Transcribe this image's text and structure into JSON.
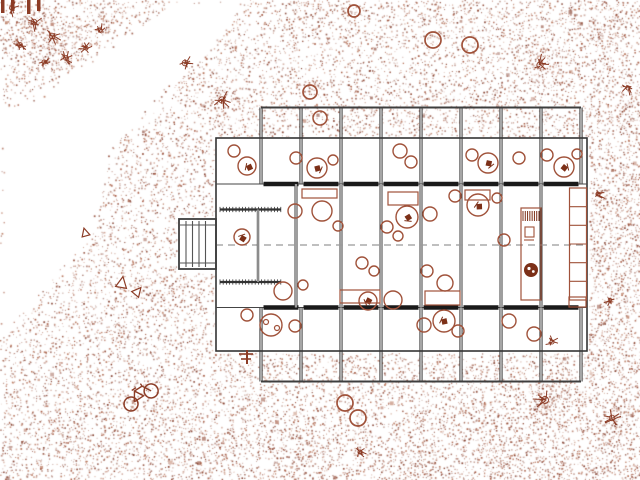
{
  "meta": {
    "drawing_type": "architectural-site-plan",
    "canvas": {
      "w": 640,
      "h": 480
    }
  },
  "colors": {
    "paper": "#ffffff",
    "wall_dark": "#3e3e3e",
    "wall_core": "#ffffff",
    "wall_heavy": "#1a1a1a",
    "outline": "#333333",
    "thin_line": "#555555",
    "axis": "#999999",
    "furniture": "#a0523a",
    "furniture_dark": "#7c3018",
    "site_sketch": "#8c3c26",
    "stipple_palette": [
      "142,69,49",
      "160,81,56",
      "178,106,78",
      "124,52,34"
    ]
  },
  "stipple": {
    "seed": 42,
    "cell": 2,
    "intensity": 0.215,
    "edge_jitter": 9,
    "base": 0.9,
    "x_gradient": 0.45,
    "y_gradient": 0.25,
    "clusters": [
      [
        30,
        28,
        20,
        2.6
      ],
      [
        62,
        52,
        16,
        2.2
      ],
      [
        96,
        16,
        13,
        2.0
      ],
      [
        185,
        63,
        9,
        2.2
      ],
      [
        222,
        100,
        10,
        2.2
      ],
      [
        310,
        8,
        14,
        1.6
      ],
      [
        356,
        12,
        8,
        1.5
      ],
      [
        540,
        65,
        13,
        2.0
      ],
      [
        612,
        28,
        15,
        1.8
      ],
      [
        634,
        120,
        18,
        1.6
      ],
      [
        616,
        200,
        15,
        1.5
      ],
      [
        604,
        262,
        13,
        1.4
      ],
      [
        596,
        330,
        14,
        1.4
      ],
      [
        545,
        400,
        15,
        1.9
      ],
      [
        612,
        418,
        13,
        1.7
      ],
      [
        500,
        452,
        15,
        1.5
      ],
      [
        420,
        465,
        13,
        1.4
      ],
      [
        310,
        455,
        13,
        1.4
      ],
      [
        230,
        442,
        12,
        1.4
      ],
      [
        150,
        438,
        14,
        1.5
      ],
      [
        70,
        430,
        13,
        1.4
      ],
      [
        170,
        292,
        11,
        1.6
      ],
      [
        120,
        330,
        11,
        1.4
      ]
    ],
    "clear_rects": [
      [
        214,
        136,
        375,
        217
      ],
      [
        177,
        216,
        40,
        56
      ]
    ],
    "clear_wedge": [
      [
        176,
        0
      ],
      [
        248,
        0
      ],
      [
        113,
        150
      ],
      [
        90,
        240
      ],
      [
        4,
        334
      ],
      [
        0,
        334
      ],
      [
        0,
        112
      ],
      [
        20,
        103
      ],
      [
        58,
        80
      ],
      [
        116,
        40
      ]
    ],
    "speck_count": 130
  },
  "building": {
    "envelope": {
      "x": 216,
      "y": 138,
      "w": 371,
      "h": 213
    },
    "bay_x": [
      261,
      301,
      341,
      381,
      421,
      461,
      501,
      541,
      581
    ],
    "terrace_top": {
      "y1": 107.5,
      "y2": 184
    },
    "terrace_bottom": {
      "y1": 307.5,
      "y2": 381.5
    },
    "band_wall_top_y": 184,
    "band_wall_bottom_y": 307.5,
    "axis": {
      "y": 245,
      "x1": 216,
      "x2": 587,
      "dash": "7 5"
    },
    "mid_partitions": [
      296,
      341,
      381,
      421,
      461,
      501,
      541
    ],
    "hatch_walls": [
      {
        "x1": 220,
        "x2": 281,
        "y": 209.5
      },
      {
        "x1": 220,
        "x2": 281,
        "y": 282
      }
    ],
    "vestibule_partition": {
      "x": 258,
      "y1": 209.5,
      "y2": 282
    },
    "stair": {
      "x": 179,
      "y": 219,
      "w": 37,
      "h": 50,
      "treads_x": [
        186,
        192.5,
        199,
        205.5
      ],
      "landing_y": [
        225,
        263
      ]
    },
    "plant_marker": {
      "x": 247,
      "y": 357
    }
  },
  "furniture": {
    "tables": [
      [
        234,
        151,
        6
      ],
      [
        247,
        166,
        9
      ],
      [
        296,
        158,
        6
      ],
      [
        317,
        168,
        10
      ],
      [
        333,
        160,
        5
      ],
      [
        400,
        151,
        7
      ],
      [
        411,
        162,
        6
      ],
      [
        472,
        155,
        6
      ],
      [
        488,
        163,
        10
      ],
      [
        519,
        158,
        6
      ],
      [
        547,
        155,
        6
      ],
      [
        564,
        167,
        10
      ],
      [
        577,
        154,
        5
      ],
      [
        322,
        211,
        10
      ],
      [
        295,
        211,
        7
      ],
      [
        338,
        226,
        5
      ],
      [
        407,
        217,
        11
      ],
      [
        387,
        227,
        6
      ],
      [
        430,
        214,
        7
      ],
      [
        398,
        236,
        5
      ],
      [
        478,
        205,
        11
      ],
      [
        497,
        198,
        5
      ],
      [
        455,
        196,
        6
      ],
      [
        504,
        240,
        6
      ],
      [
        242,
        237,
        8
      ],
      [
        283,
        291,
        9
      ],
      [
        303,
        285,
        5
      ],
      [
        368,
        301,
        9
      ],
      [
        393,
        300,
        9
      ],
      [
        362,
        263,
        6
      ],
      [
        374,
        271,
        5
      ],
      [
        427,
        271,
        6
      ],
      [
        445,
        283,
        8
      ],
      [
        271,
        325,
        11
      ],
      [
        295,
        326,
        6
      ],
      [
        247,
        315,
        6
      ],
      [
        444,
        321,
        11
      ],
      [
        424,
        325,
        7
      ],
      [
        458,
        331,
        6
      ],
      [
        509,
        321,
        7
      ],
      [
        534,
        334,
        7
      ]
    ],
    "terrace_table": [
      320,
      118,
      7
    ],
    "chair_glyphs": [
      [
        249,
        167
      ],
      [
        318,
        169
      ],
      [
        489,
        164
      ],
      [
        565,
        168
      ],
      [
        408,
        218
      ],
      [
        479,
        206
      ],
      [
        368,
        301
      ],
      [
        444,
        321
      ],
      [
        243,
        238
      ]
    ],
    "eye_glyphs": [
      [
        266,
        322
      ],
      [
        277,
        328
      ]
    ],
    "rect_tables": [
      [
        302,
        189,
        35,
        9
      ],
      [
        388,
        192,
        30,
        13
      ],
      [
        465,
        190,
        25,
        10
      ],
      [
        340,
        290,
        40,
        13
      ],
      [
        425,
        291,
        35,
        14
      ],
      [
        569,
        297,
        17,
        10
      ]
    ],
    "shelving": {
      "x": 569.5,
      "y": 188,
      "w": 17,
      "h": 112,
      "cells": 6
    },
    "counter": {
      "x": 521,
      "y": 208,
      "w": 20,
      "h": 92,
      "stripes": {
        "x1": 523,
        "x2": 539,
        "y1": 211,
        "y2": 221,
        "n": 8
      },
      "small_box": [
        525,
        227,
        9,
        10
      ],
      "tick": [
        524,
        240,
        534,
        240
      ]
    },
    "flower_blob": {
      "x": 531,
      "y": 270,
      "r": 7
    }
  },
  "site": {
    "tree_circles": [
      [
        310,
        92,
        7
      ],
      [
        354,
        11,
        6
      ],
      [
        433,
        40,
        8
      ],
      [
        470,
        45,
        8
      ],
      [
        345,
        403,
        8
      ],
      [
        358,
        418,
        8
      ]
    ],
    "shrubs": [
      [
        12,
        8,
        7
      ],
      [
        34,
        22,
        8
      ],
      [
        20,
        45,
        7
      ],
      [
        52,
        36,
        8
      ],
      [
        66,
        58,
        7
      ],
      [
        44,
        62,
        6
      ],
      [
        86,
        48,
        6
      ],
      [
        185,
        63,
        8
      ],
      [
        222,
        100,
        9
      ],
      [
        540,
        65,
        9
      ],
      [
        545,
        400,
        10
      ],
      [
        612,
        418,
        8
      ],
      [
        552,
        342,
        6
      ],
      [
        610,
        300,
        5
      ],
      [
        628,
        88,
        6
      ],
      [
        598,
        194,
        6
      ],
      [
        360,
        452,
        6
      ],
      [
        100,
        30,
        6
      ]
    ],
    "triangles": [
      [
        85,
        232,
        8,
        -15
      ],
      [
        122,
        282,
        11,
        10
      ],
      [
        138,
        291,
        9,
        40
      ]
    ],
    "bicycle": {
      "x": 131,
      "y": 404,
      "angle": -33,
      "wheel_r": 7,
      "wheel_gap": 24
    },
    "corner_bars": {
      "xs": [
        1,
        11,
        27,
        37
      ],
      "w": 3.5,
      "hs": [
        13,
        11,
        14,
        11
      ]
    }
  }
}
